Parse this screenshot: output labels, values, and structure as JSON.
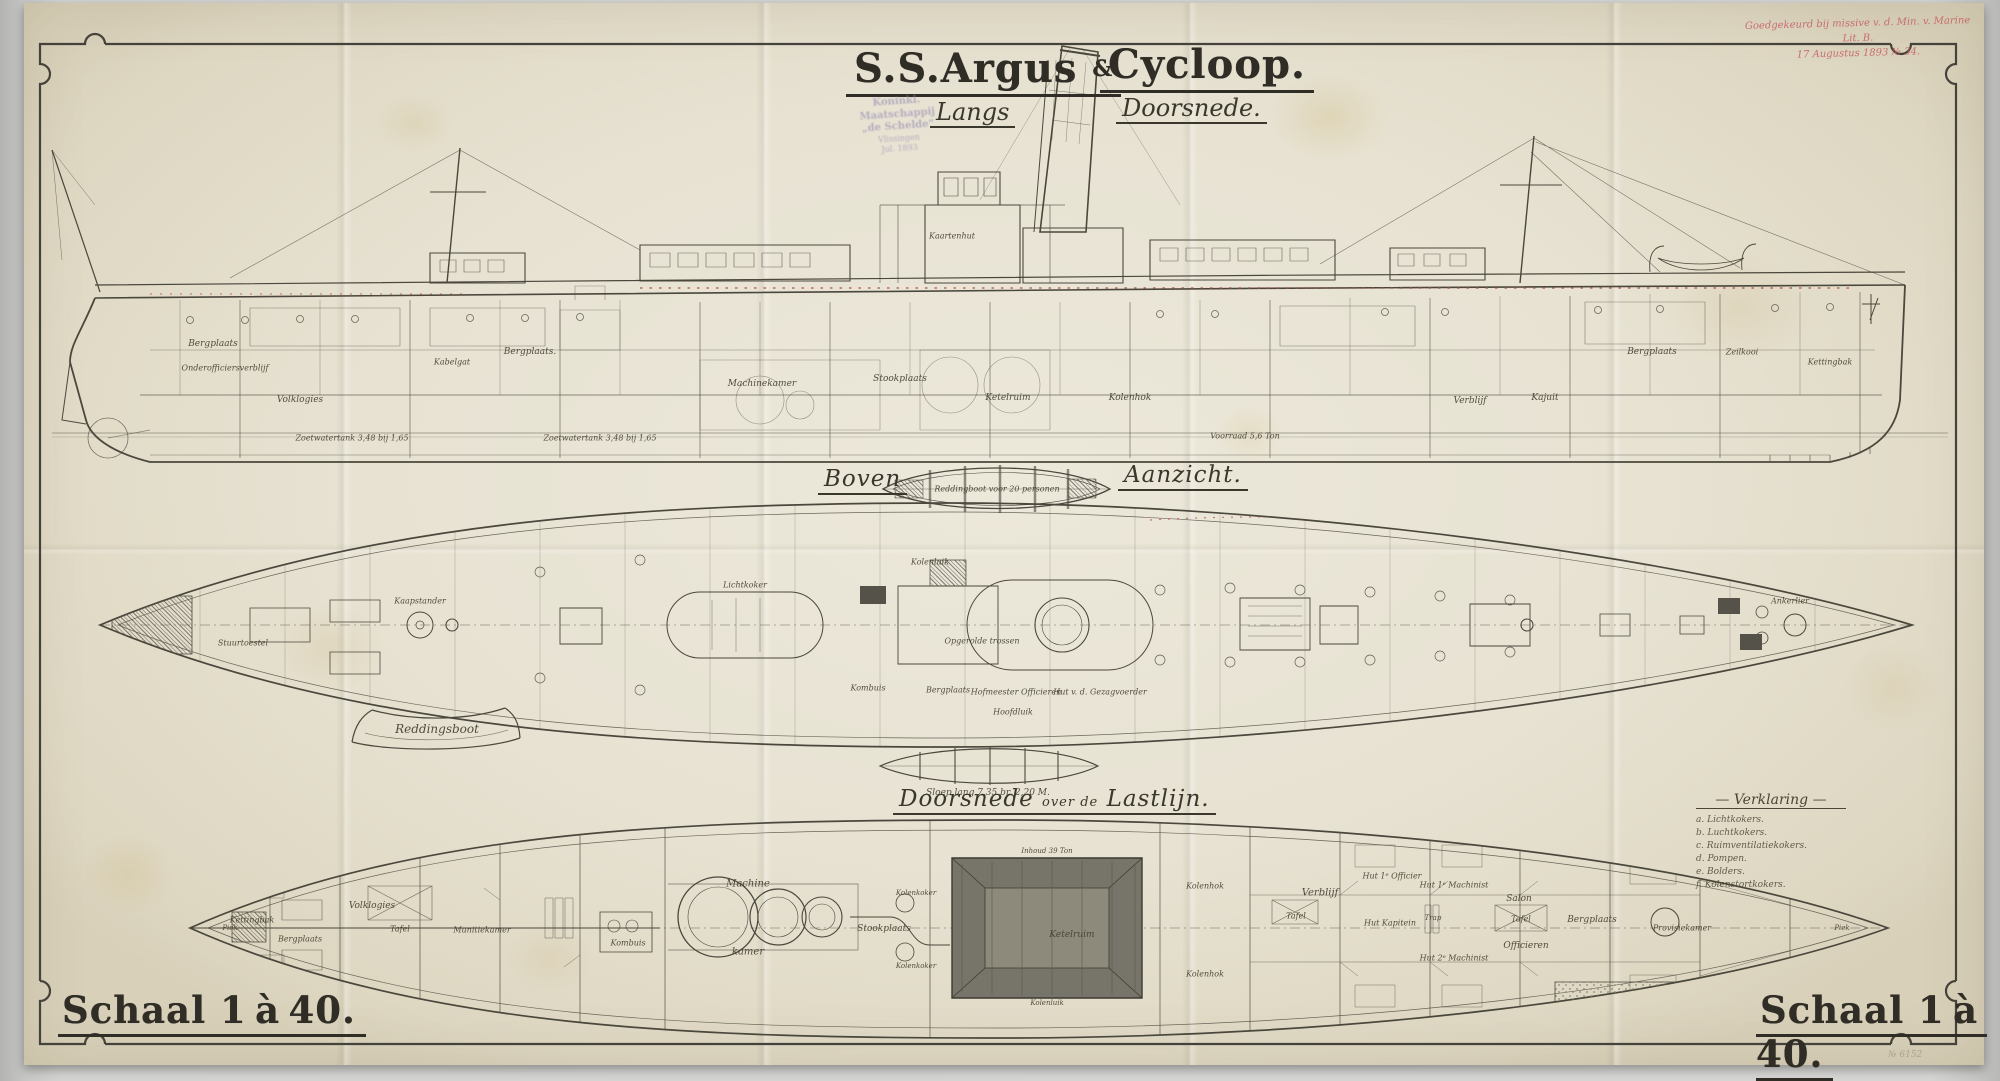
{
  "title": {
    "left": "S.S.Argus",
    "amp": "&",
    "right": "Cycloop.",
    "sub_left": "Langs",
    "sub_right": "Doorsnede."
  },
  "stamp": {
    "line1": "Koninkl. Maatschappij",
    "line2": "„de Schelde”",
    "line3": "Vlissingen",
    "line4": "Jul. 1893"
  },
  "annotation_red": {
    "line1": "Goedgekeurd bij missive v. d. Min. v. Marine Lit. B.",
    "line2": "17 Augustus 1893 № 34."
  },
  "view_headers": {
    "plan_left": "Boven",
    "plan_right": "Aanzicht.",
    "section_a": "Doorsnede",
    "section_b": "over de",
    "section_c": "Lastlijn."
  },
  "legend": {
    "title": "— Verklaring —",
    "items": [
      "a.  Lichtkokers.",
      "b.  Luchtkokers.",
      "c.  Ruimventilatiekokers.",
      "d.  Pompen.",
      "e.  Bolders.",
      "f.  Kolenstortkokers."
    ]
  },
  "scale_left": "Schaal 1 à 40.",
  "scale_right": "Schaal 1 à 40.",
  "pencil_note": "№ 6152",
  "colors": {
    "ink": "#46433a",
    "red_accent": "#b0483f",
    "stamp_purple": "#8d81ad",
    "paper": "#e9e5d6"
  },
  "labels": {
    "side": [
      {
        "t": "Bergplaats",
        "x": 213,
        "y": 344
      },
      {
        "t": "Onderofficiersverblijf",
        "x": 225,
        "y": 368,
        "s": 8
      },
      {
        "t": "Volklogies",
        "x": 300,
        "y": 400
      },
      {
        "t": "Bergplaats.",
        "x": 530,
        "y": 352
      },
      {
        "t": "Kabelgat",
        "x": 452,
        "y": 362,
        "s": 8
      },
      {
        "t": "Machinekamer",
        "x": 762,
        "y": 384
      },
      {
        "t": "Stookplaats",
        "x": 900,
        "y": 379
      },
      {
        "t": "Ketelruim",
        "x": 1008,
        "y": 398
      },
      {
        "t": "Kolenhok",
        "x": 1130,
        "y": 398
      },
      {
        "t": "Verblijf",
        "x": 1470,
        "y": 401
      },
      {
        "t": "Kajuit",
        "x": 1545,
        "y": 398
      },
      {
        "t": "Bergplaats",
        "x": 1652,
        "y": 352
      },
      {
        "t": "Zeilkooi",
        "x": 1742,
        "y": 352,
        "s": 8
      },
      {
        "t": "Kettingbak",
        "x": 1830,
        "y": 362,
        "s": 8
      },
      {
        "t": "Kaartenhut",
        "x": 952,
        "y": 236,
        "s": 8
      },
      {
        "t": "Zoetwatertank 3,48 bij 1,65",
        "x": 352,
        "y": 438,
        "s": 8
      },
      {
        "t": "Zoetwatertank 3,48 bij 1,65",
        "x": 600,
        "y": 438,
        "s": 8
      },
      {
        "t": "Voorraad 5,6 Ton",
        "x": 1245,
        "y": 436,
        "s": 8
      }
    ],
    "plan": [
      {
        "t": "Kombuis",
        "x": 868,
        "y": 688,
        "s": 8
      },
      {
        "t": "Bergplaats",
        "x": 948,
        "y": 690,
        "s": 8
      },
      {
        "t": "Hofmeester Officieren",
        "x": 1016,
        "y": 692,
        "s": 8
      },
      {
        "t": "Hoofdluik",
        "x": 1013,
        "y": 712,
        "s": 8
      },
      {
        "t": "Hut v. d. Gezagvoerder",
        "x": 1100,
        "y": 692,
        "s": 8
      },
      {
        "t": "Opgerolde trossen",
        "x": 982,
        "y": 641,
        "s": 8
      },
      {
        "t": "Lichtkoker",
        "x": 745,
        "y": 585,
        "s": 8
      },
      {
        "t": "Kolenluik",
        "x": 930,
        "y": 562,
        "s": 8
      },
      {
        "t": "Kaapstander",
        "x": 420,
        "y": 601,
        "s": 8
      },
      {
        "t": "Ankerlier",
        "x": 1790,
        "y": 601,
        "s": 8
      },
      {
        "t": "Stuurtoestel",
        "x": 243,
        "y": 643,
        "s": 8
      }
    ],
    "boats": [
      {
        "t": "Reddingboot voor 20 personen",
        "x": 997,
        "y": 489,
        "s": 8
      },
      {
        "t": "Reddingsboot",
        "x": 437,
        "y": 729,
        "s": 12
      },
      {
        "t": "Sloep lang 7,35 br. 2,20 M.",
        "x": 988,
        "y": 793,
        "s": 9
      }
    ],
    "section": [
      {
        "t": "Machine",
        "x": 748,
        "y": 884,
        "s": 10
      },
      {
        "t": "kamer",
        "x": 748,
        "y": 952,
        "s": 10
      },
      {
        "t": "Stookplaats",
        "x": 884,
        "y": 929,
        "s": 9
      },
      {
        "t": "Kolenkoker",
        "x": 916,
        "y": 893,
        "s": 7
      },
      {
        "t": "Kolenkoker",
        "x": 916,
        "y": 966,
        "s": 7
      },
      {
        "t": "Ketelruim",
        "x": 1072,
        "y": 935,
        "s": 9
      },
      {
        "t": "Inhoud 39 Ton",
        "x": 1047,
        "y": 851,
        "s": 7
      },
      {
        "t": "Kolenluik",
        "x": 1047,
        "y": 1003,
        "s": 7
      },
      {
        "t": "Kolenhok",
        "x": 1205,
        "y": 886,
        "s": 8
      },
      {
        "t": "Kolenhok",
        "x": 1205,
        "y": 974,
        "s": 8
      },
      {
        "t": "Verblijf",
        "x": 1320,
        "y": 893,
        "s": 10
      },
      {
        "t": "Tafel",
        "x": 1296,
        "y": 916,
        "s": 8
      },
      {
        "t": "Hut 1ᵉ Officier",
        "x": 1392,
        "y": 876,
        "s": 8
      },
      {
        "t": "Hut Kapitein",
        "x": 1390,
        "y": 923,
        "s": 8
      },
      {
        "t": "Hut 1ᵉ Machinist",
        "x": 1454,
        "y": 885,
        "s": 8
      },
      {
        "t": "Hut 2ᵉ Machinist",
        "x": 1454,
        "y": 958,
        "s": 8
      },
      {
        "t": "Trap",
        "x": 1433,
        "y": 918,
        "s": 7
      },
      {
        "t": "Salon",
        "x": 1519,
        "y": 899,
        "s": 9
      },
      {
        "t": "Tafel",
        "x": 1521,
        "y": 919,
        "s": 8
      },
      {
        "t": "Officieren",
        "x": 1526,
        "y": 946,
        "s": 9
      },
      {
        "t": "Bergplaats",
        "x": 1592,
        "y": 920,
        "s": 9
      },
      {
        "t": "Provisiekamer",
        "x": 1682,
        "y": 928,
        "s": 8
      },
      {
        "t": "Volklogies",
        "x": 372,
        "y": 906,
        "s": 9
      },
      {
        "t": "Tafel",
        "x": 400,
        "y": 929,
        "s": 8
      },
      {
        "t": "Bergplaats",
        "x": 300,
        "y": 939,
        "s": 8
      },
      {
        "t": "Kettingbak",
        "x": 252,
        "y": 920,
        "s": 8
      },
      {
        "t": "Kombuis",
        "x": 628,
        "y": 943,
        "s": 8
      },
      {
        "t": "Munitiekamer",
        "x": 482,
        "y": 930,
        "s": 8
      },
      {
        "t": "Piek",
        "x": 230,
        "y": 928,
        "s": 7
      },
      {
        "t": "Piek",
        "x": 1842,
        "y": 928,
        "s": 7
      }
    ]
  }
}
